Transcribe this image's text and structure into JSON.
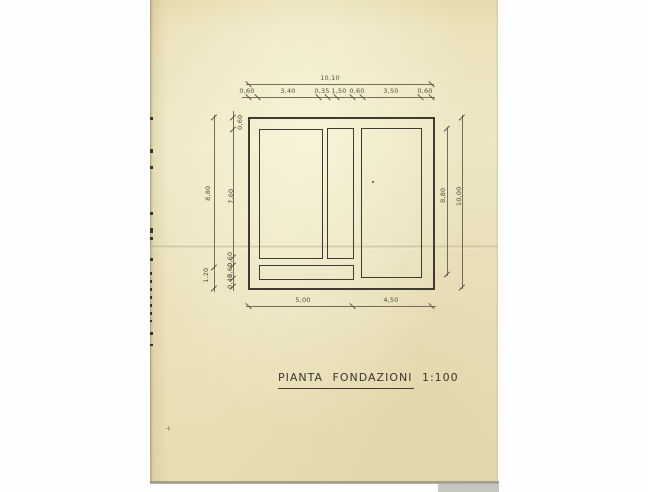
{
  "scan": {
    "paper_color": "#ece3bf",
    "ink_color": "#3f3b30",
    "dim_text_color": "#55503f"
  },
  "title": {
    "text": "PIANTA FONDAZIONI 1:100"
  },
  "dims": {
    "top_total": "10,10",
    "top_segments": [
      "0,60",
      "3,40",
      "0,35",
      "1,50",
      "0,60",
      "3,50",
      "0,60"
    ],
    "left_outer_main": "8,80",
    "left_outer_bottom": "1,20",
    "left_inner_top": "0,60",
    "left_inner_main": "7,60",
    "left_inner_bottom": [
      "0,60",
      "0,60",
      "0,45"
    ],
    "right_inner": "8,80",
    "right_outer": "10,00",
    "bottom_left": "5,00",
    "bottom_right": "4,50"
  }
}
